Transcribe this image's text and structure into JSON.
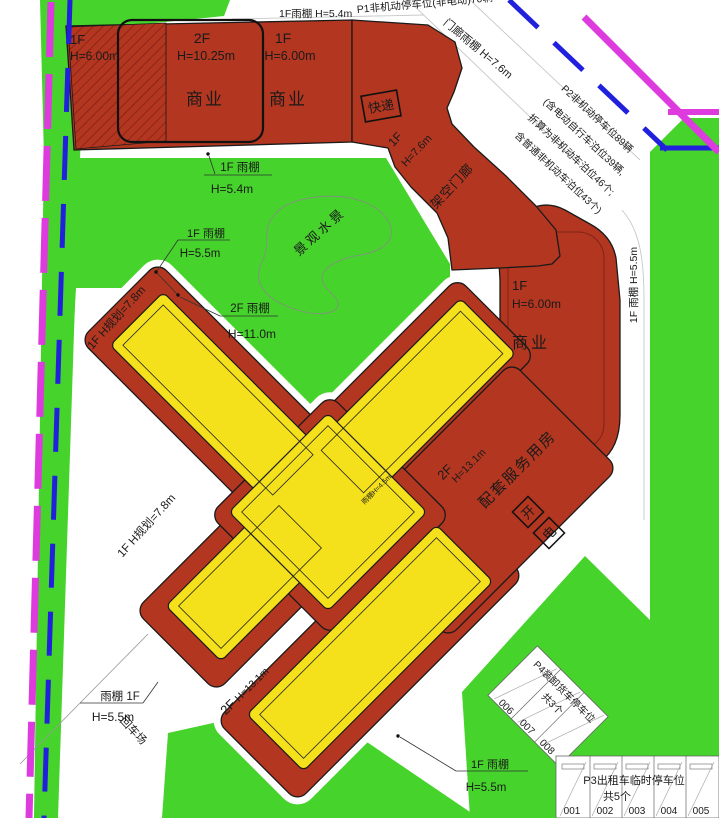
{
  "colors": {
    "green": "#46D32B",
    "building_red": "#B23620",
    "tower_yellow": "#F5E11B",
    "boundary_magenta": "#DD3BDD",
    "line_blue": "#2020DD"
  },
  "labels": {
    "top_cut": "P1非机动停车位(非电动)70辆",
    "top_canopy": "1F雨棚  H=5.4m",
    "blk1_floor": "1F",
    "blk1_h": "H=6.00m",
    "blk2_floor": "2F",
    "blk2_h": "H=10.25m",
    "blk2_use": "商业",
    "blk3_floor": "1F",
    "blk3_h": "H=6.00m",
    "blk3_use": "商业",
    "express": "快递",
    "porch_canopy": "门廊雨棚  H=7.6m",
    "blk4_floor": "1F",
    "blk4_h": "H=7.6m",
    "blk4_use": "架空门廊",
    "p2_line1": "P2非机动停车位89辆",
    "p2_line2": "(含电动自行车泊位39辆,",
    "p2_line3": "折算为非机动车泊位46个;",
    "p2_line4": "含普通非机动车泊位43个)",
    "canopy54_l1": "1F 雨棚",
    "canopy54_l2": "H=5.4m",
    "canopy55_l1": "1F 雨棚",
    "canopy55_l2": "H=5.5m",
    "water": "景观水景",
    "canopy2f_l1": "2F 雨棚",
    "canopy2f_l2": "H=11.0m",
    "rblk_floor": "1F",
    "rblk_h": "H=6.00m",
    "rblk_use": "商业",
    "right_canopy": "1F 雨棚  H=5.5m",
    "hplan_upper": "1F  H规划=7.8m",
    "hplan_lower": "1F  H规划=7.8m",
    "center_floor": "2F",
    "center_h": "H=13.1m",
    "service": "配套服务用房",
    "box_kai": "开",
    "box_dian": "电",
    "small_canopy": "雨棚H=4.5m",
    "bl_canopy_l1": "雨棚 1F",
    "bl_canopy_l2": "H=5.5m",
    "turnaround": "回车场",
    "bottom_floor": "2F",
    "bottom_h": "H=13.1m",
    "bottom_canopy_l1": "1F 雨棚",
    "bottom_canopy_l2": "H=5.5m",
    "p4_l1": "P4装卸货车停车位",
    "p4_l2": "共3个",
    "p4_stalls": [
      "006",
      "007",
      "008"
    ],
    "p3_l1": "P3出租车临时停车位",
    "p3_l2": "共5个",
    "p3_stalls": [
      "001",
      "002",
      "003",
      "004",
      "005"
    ]
  }
}
